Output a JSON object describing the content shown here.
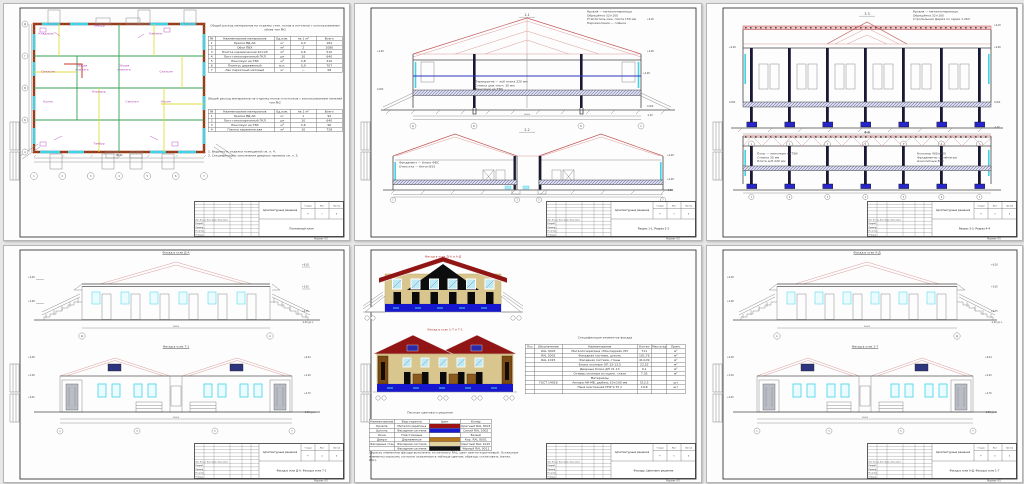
{
  "tb": {
    "project": "Архитектурные решения",
    "stage_h": "Стадия",
    "sheet_h": "Лист",
    "sheets_h": "Листов",
    "stage": "Р",
    "total": "6",
    "cols_h": "Изм. Кол.уч. Лист №док. Подп. Дата",
    "sign_rows": [
      "Разраб.",
      "Провер.",
      "Н.контр.",
      "Утверд."
    ],
    "format": "Формат А3"
  },
  "colors": {
    "roof_red": "#911515",
    "plinth_blue": "#1717cf",
    "wall_tan": "#d9c68e",
    "window_cyan": "#3fd2e8",
    "wall_brown": "#7d3f14",
    "partition_green": "#33a053",
    "partition_yellow": "#dede3c",
    "annotation_magenta": "#b545b5",
    "foundation_blue": "#2626cc",
    "truss_pink": "#dc9a9a",
    "pediment_black": "#0d0d0d"
  },
  "s1": {
    "no": "1",
    "doc": "Поэтажный план",
    "t1_title": "Общий расход материалов на отделку стен, полов и потолков с использованием обоев тип №1",
    "t2_title": "Общий расход материалов на отделку полов и потолков с использованием панелей тип №2",
    "t1_rows": [
      [
        "№",
        "Наименование материалов",
        "Ед.изм.",
        "на 1 м²",
        "Всего"
      ],
      [
        "1",
        "Краска ВД-АК",
        "кг",
        "0,4",
        "162"
      ],
      [
        "2",
        "Обои ПВХ",
        "м²",
        "2",
        "1080"
      ],
      [
        "3",
        "Плитка керамическая 20×20",
        "м²",
        "0,6",
        "510"
      ],
      [
        "4",
        "Лист гипсокартонный ГКЛ",
        "шт",
        "10",
        "640"
      ],
      [
        "5",
        "Линолеум на ТЗИ",
        "м²",
        "0,8",
        "410"
      ],
      [
        "6",
        "Плинтус деревянный",
        "м.п.",
        "0,9",
        "707"
      ],
      [
        "7",
        "Лак паркетный матовый",
        "кг",
        "—",
        "58"
      ]
    ],
    "t2_rows": [
      [
        "№",
        "Наименование материалов",
        "Ед.изм.",
        "на 1 м²",
        "Всего"
      ],
      [
        "1",
        "Краска ВД-АК",
        "кг",
        "1",
        "92"
      ],
      [
        "2",
        "Лист гипсокартонный ГКЛ",
        "шт",
        "10",
        "640"
      ],
      [
        "3",
        "Линолеум на ТЗИ",
        "м²",
        "0,6",
        "96"
      ],
      [
        "4",
        "Плитка керамическая",
        "м²",
        "10",
        "728"
      ]
    ],
    "notes": "1. Ведомость отделки помещений см. л. 4.\n2. Спецификацию заполнения дверных проемов см. л. 5.",
    "rooms": [
      "Тамбур",
      "Кладовая",
      "Кабинет",
      "Общая комната",
      "Общая комната",
      "Спальня",
      "Спальня",
      "Кухня",
      "Кухня",
      "Коридор",
      "Санузел",
      "Тамбур"
    ],
    "axes_b": [
      "1",
      "2",
      "3",
      "4",
      "5",
      "6",
      "7"
    ],
    "axes_l": [
      "Д",
      "Г",
      "В",
      "Б",
      "А"
    ],
    "total_w": "36000"
  },
  "s2": {
    "no": "2",
    "doc": "Разрез 1-1. Разрез 2-2",
    "sec1": "1-1",
    "sec2": "2-2",
    "note1": "Кровля — металлочерепица\nОбрешётка 32×100\nУтеплитель мин. плита 150 мм\nПароизоляция — плёнка",
    "note2": "Перекрытие — ж/б плита 220 мм\nСтяжка цем.-песч. 30 мм\nЛинолеум на ТЗИ",
    "note3": "Фундамент — блоки ФБС\nОтмостка — бетон В15",
    "marks": [
      "+6,18",
      "+4,48",
      "+2,98",
      "0,000",
      "-1,20"
    ],
    "axes1": [
      "Д",
      "В",
      "Б",
      "А"
    ],
    "axes2": [
      "1",
      "3",
      "5",
      "7"
    ],
    "dim": "24000"
  },
  "s3": {
    "no": "3",
    "doc": "Разрез 3-3. Разрез 4-4",
    "sec1": "3-3",
    "sec2": "4-4",
    "note1": "Кровля — металлочерепица\nОбрешётка 32×100\nСтропильная ферма по серии 1.263",
    "note2": "Полы — линолеум на ТЗИ\nСтяжка 30 мм\nПлита ж/б 220 мм",
    "note3": "Колонны 400×400\nФундаменты столбчатые\nмонолитные В20",
    "marks": [
      "+6,18",
      "+4,48",
      "+2,98",
      "0,000",
      "-1,20"
    ],
    "axes": [
      "1",
      "2",
      "3",
      "4",
      "5",
      "6",
      "7"
    ],
    "dim": "36000"
  },
  "s4": {
    "no": "4",
    "doc": "Фасад в осях Д-А. Фасад в осях 7-1",
    "elev1": "Фасад в осях Д-А",
    "elev2": "Фасад в осях 7-1",
    "marks_l": [
      "+4,48",
      "+2,98"
    ],
    "marks_r": [
      "+6,18",
      "+5,05",
      "+0,75",
      "-1,20 ур.з."
    ],
    "m2l": [
      "+4,48",
      "+3,09",
      "+0,45"
    ],
    "m2r": [
      "+6,44",
      "+4,20",
      "+2,70",
      "-1,20 ур.з."
    ],
    "axes1": [
      "Д",
      "А"
    ],
    "axes2": [
      "1",
      "3",
      "5",
      "7"
    ],
    "dim1": "36000",
    "dim2": "36000"
  },
  "s5": {
    "no": "5",
    "doc": "Фасады. Цветовое решение",
    "f1_title": "Фасад в осях Д-А и А-Д",
    "f2_title": "Фасад в осях 1-7 и 7-1",
    "passport_title": "Паспорт цветового решения",
    "passport_rows": [
      [
        "Наименование",
        "Вид отделки",
        "Цвет",
        "Колер"
      ],
      [
        "Кровля",
        "Металлочерепица",
        "#9c1414",
        "Красный RAL 3003"
      ],
      [
        "Цоколь",
        "Фасадная система",
        "#1a1ace",
        "Синий RAL 5002"
      ],
      [
        "Окна",
        "Пластиковые",
        "",
        "Белый"
      ],
      [
        "Двери",
        "Деревянные",
        "#b5761d",
        "Кор. RAL 8001"
      ],
      [
        "Фасадные стены",
        "Фасадная система",
        "#e2d3a1",
        "Светлый RAL 1015"
      ],
      [
        "",
        "Фасадная система",
        "#141414",
        "Чёрный RAL 9011"
      ]
    ],
    "spec_title": "Спецификация элементов фасада",
    "spec_rows": [
      [
        "Поз",
        "Обозначение",
        "Наименование",
        "Кол-во",
        "Масса ед., кг",
        "Прим."
      ],
      [
        "",
        "RAL 3003",
        "Металлочерепица «Монтеррей» МЧ",
        "711",
        "",
        "м²"
      ],
      [
        "",
        "RAL 5002",
        "Фасадная система, цоколь",
        "101,76",
        "",
        "м²"
      ],
      [
        "",
        "RAL 1015",
        "Фасадная система, стены",
        "414,09",
        "",
        "м²"
      ],
      [
        "",
        "",
        "Блоки оконные ОП 15-13,5",
        "23,52",
        "",
        "м²"
      ],
      [
        "",
        "",
        "Дверные блоки ДН 21-13",
        "9,1",
        "",
        "м²"
      ],
      [
        "",
        "",
        "Отливы оконные из оцинк. стали",
        "7,35",
        "",
        "м²"
      ],
      [
        "",
        "",
        "Материалы",
        "",
        "",
        ""
      ],
      [
        "",
        "ГОСТ 14918",
        "Анкера НН-МБ, дюбель 10×100 мм",
        "513,5",
        "",
        "шт"
      ],
      [
        "",
        "",
        "Пена монтажная ППУ 0,75 л",
        "19,8",
        "",
        "шт"
      ],
      [
        "",
        "",
        "",
        "",
        "",
        ""
      ]
    ],
    "note": "Окраску элементов фасада выполнять по каталогу RAL; цвет светло-коричневый. Остальные элементы окрасить согласно указанным в таблице цветам; образцы согласовать (катал. RAL)."
  },
  "s6": {
    "no": "6",
    "doc": "Фасад в осях А-Д. Фасад в осях 1-7",
    "elev1": "Фасад в осях А-Д",
    "elev2": "Фасад в осях 1-7",
    "marks_l": [
      "+4,48",
      "+2,98"
    ],
    "marks_r": [
      "+6,18",
      "+5,05",
      "+0,75",
      "-1,20 ур.з."
    ],
    "m2l": [
      "+4,48",
      "+3,09",
      "+0,45"
    ],
    "m2r": [
      "+6,44",
      "+4,20",
      "+2,70",
      "-1,20 ур.з."
    ],
    "axes1": [
      "А",
      "Д"
    ],
    "axes2": [
      "1",
      "3",
      "5",
      "7"
    ],
    "dim1": "36000",
    "dim2": "36000"
  }
}
